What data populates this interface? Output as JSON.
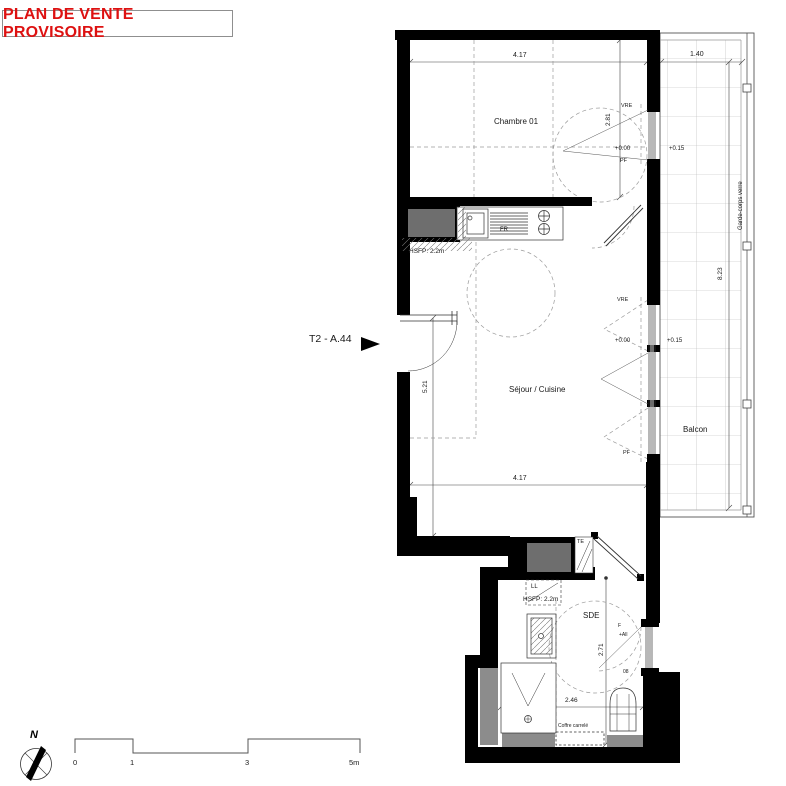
{
  "title": "PLAN DE VENTE PROVISOIRE",
  "unit": {
    "label": "T2 - A.44"
  },
  "rooms": {
    "bedroom": "Chambre 01",
    "living": "Séjour / Cuisine",
    "shower_room": "SDE",
    "balcony": "Balcon"
  },
  "dimensions": {
    "bedroom_width": "4.17",
    "bedroom_depth": "2.81",
    "balcony_width": "1.40",
    "balcony_length": "8.23",
    "living_depth": "5.21",
    "living_width": "4.17",
    "sde_depth": "2.71",
    "sde_width": "2.46"
  },
  "levels": {
    "bedroom_level": "+0.00",
    "living_level": "+0.00",
    "balcony_level_a": "+0.15",
    "balcony_level_b": "+0.15",
    "sde_sill": "+All"
  },
  "annotations": {
    "vre_bedroom": "VRE",
    "pf_bedroom": "PF",
    "vre_living": "VRE",
    "pf_living": "PF",
    "fridge": "FR",
    "electrical_panel": "TE",
    "washing_machine": "LL",
    "hsfp_kitchen": "HSFP: 2.2m",
    "hsfp_sde": "HSFP: 2.2m",
    "guardrail": "Garde-corps verre",
    "tiled_box": "Coffre carrelé",
    "window_f": "F",
    "ref_08": "08"
  },
  "scale_bar": {
    "ticks": [
      "0",
      "1",
      "3",
      "5m"
    ]
  },
  "north": {
    "label": "N"
  },
  "icons": {
    "north_arrow": "compass-needle",
    "unit_pointer": "right-triangle"
  },
  "colors": {
    "title_red": "#dd1111",
    "wall_black": "#000000",
    "duct_gray": "#6e6e6e",
    "ledge_gray": "#8c8c8c"
  }
}
